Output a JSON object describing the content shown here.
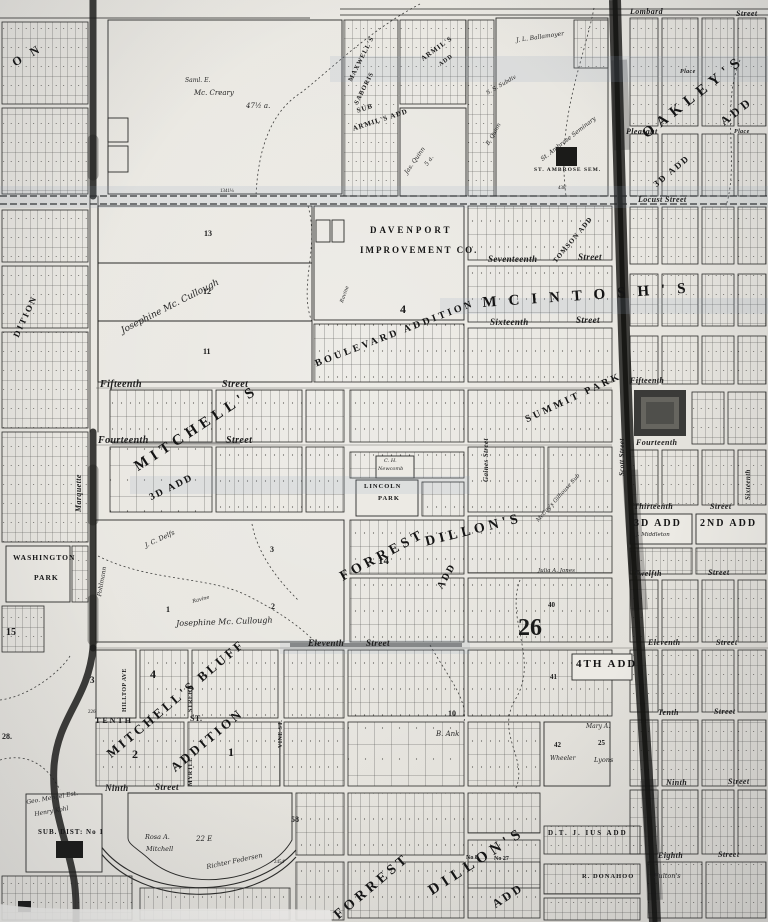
{
  "photo": {
    "paper_color": "#e8e6e0",
    "ink_color": "#1f1f1f",
    "road_color": "#161616",
    "scan_tint_color": "#8da0be"
  },
  "streets": {
    "lombard": "Lombard",
    "lombard_st": "Street",
    "pleasant": "Pleasant",
    "place_top": "Place",
    "place_2": "Place",
    "locust": "Locust  Street",
    "seventeenth": "Seventeenth",
    "seventeenth_st": "Street",
    "sixteenth": "Sixteenth",
    "sixteenth_st": "Street",
    "fifteenth_w": "Fifteenth",
    "fifteenth_w_st": "Street",
    "fifteenth_e": "Fifteenth",
    "fourteenth_w": "Fourteenth",
    "fourteenth_w_st": "Street",
    "fourteenth_e": "Fourteenth",
    "thirteenth_e": "Thirteenth",
    "thirteenth_e_st": "Street",
    "twelfth_e": "Twelfth",
    "twelfth_e_st": "Street",
    "eleventh_w": "Eleventh",
    "eleventh_w_st": "Street",
    "eleventh_e": "Eleventh",
    "eleventh_e_st": "Street",
    "tenth_w": "TENTH",
    "tenth_w_st": "ST.",
    "tenth_e": "Tenth",
    "tenth_e_st": "Street",
    "ninth_w": "Ninth",
    "ninth_w_st": "Street",
    "ninth_e": "Ninth",
    "ninth_e_st": "Street",
    "eighth_e": "Eighth",
    "eighth_e_st": "Street",
    "marquette": "Marquette",
    "hilltop": "HILLTOP AVE",
    "myrtle_street": "STREET",
    "myrtle": "MYRTLE",
    "vine": "VINE ST.",
    "gaines": "Gaines Street",
    "scott": "Scott Street",
    "sixteenth_v": "Sixteenth"
  },
  "additions": {
    "mitchells": "MITCHELL'S",
    "third_add": "3D ADD",
    "mitchells_bluff": "MITCHELL'S BLUFF",
    "addition_word": "ADDITION",
    "forrest_mid": "FORREST",
    "dillons_mid": "DILLON'S",
    "add_mid": "ADD",
    "n14": "14",
    "forrest_bot": "FORREST",
    "dillons_bot": "DILLON'S",
    "add_bot": "ADD",
    "no8": "No 8",
    "no27": "No 27",
    "mcintosh": "MCINTOSH'S",
    "boulevard": "BOULEVARD  ADDITION",
    "summit": "SUMMIT PARK",
    "tomson": "TOMSON ADD",
    "maxwells": "MAXWELL'S",
    "saboris": "SABORIS",
    "armils": "ARMIL'S",
    "armils_add": "ADD",
    "sub_word": "SUB",
    "sub_armils": "ARMIL'S ADD",
    "oakleys": "OAKLEY'S",
    "oakley_add": "ADD",
    "third_add_ne": "3D ADD",
    "third_add_box": "3D ADD",
    "middleton": "J. Middleton",
    "second_add_box": "2ND ADD",
    "fourth_add": "4TH ADD",
    "dtji": "D.T. J. IUS ADD",
    "donahoo": "R. DONAHOO",
    "fultons": "Fulton's",
    "on_partial": "O N",
    "dition": "DITION"
  },
  "parks": {
    "lincoln_1": "LINCOLN",
    "lincoln_2": "PARK",
    "washington_1": "WASHINGTON",
    "washington_2": "PARK"
  },
  "companies": {
    "davenport_1": "DAVENPORT",
    "davenport_2": "IMPROVEMENT  CO."
  },
  "landmarks": {
    "st_ambrose": "ST. AMBROSE SEM.",
    "sub_dist": "SUB. DIST: No 1"
  },
  "owners": {
    "mccreary_1": "Saml. E.",
    "mccreary_2": "Mc. Creary",
    "mccreary_3": "47½ a.",
    "josephine_nw": "Josephine  Mc. Cullough",
    "josephine_s": "Josephine  Mc. Cullough",
    "jas_quinn": "Jas. Quinn",
    "quinn_5a": "5 a.",
    "b_quinn": "B. Quinn",
    "ss_subdiv": "S. S. Subdiv",
    "ballamoyer": "J. L. Ballamoyer",
    "seminary": "St. Ambrose Seminary",
    "mengel": "Geo. Mengel Est.",
    "kohl": "Henry Kohl",
    "rosa_1": "Rosa A.",
    "rosa_2": "Mitchell",
    "e22": "22 E",
    "richter": "Richter Federsen",
    "julia": "Julia A. Jones",
    "b_ank": "B. Ank",
    "mary_a": "Mary A.",
    "wheeler": "Wheeler",
    "lyons": "Lyons",
    "delfs": "J. C. Delfs",
    "pohlmann": "Pohlmann",
    "mccoys": "McCoy's Gilhouse Sub",
    "newcomb_1": "C. H.",
    "newcomb_2": "Newcomb"
  },
  "numbers": {
    "n13": "13",
    "n12": "12",
    "n11": "11",
    "n1": "1",
    "n2": "2",
    "n3": "3",
    "n3b": "3",
    "n15": "15",
    "n28": "28.",
    "n26": "26",
    "n58": "58",
    "n40": "40",
    "n41": "41",
    "n42": "42",
    "n25": "25",
    "n2big": "2",
    "n1big": "1",
    "n4big": "4",
    "n4c": "4",
    "n10": "10",
    "m1341": "1341¼",
    "m438": "438'",
    "m226": "226'",
    "m2454": "2454'"
  },
  "annotations": {
    "ravine_1": "Ravine",
    "ravine_2": "Ravine"
  }
}
